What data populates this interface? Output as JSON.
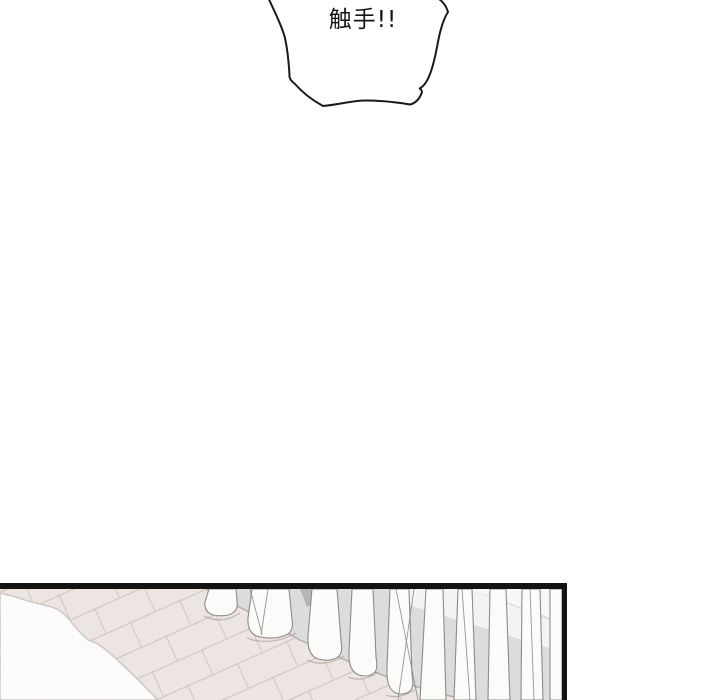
{
  "comic": {
    "speech_bubble": {
      "text": "触手!!",
      "fill": "#ffffff",
      "stroke": "#1a1a1a",
      "text_color": "#151515"
    },
    "panel": {
      "border_color": "#131313",
      "scene_colors": {
        "floor": "#ece5e1",
        "floor_seam": "#cdc2bb",
        "rug": "#fcfcfc",
        "rug_edge": "#cfc9c5",
        "wall": "#dcdcde",
        "wall_gap_shadow": "#b8b4b1",
        "wall_highlight": "#f7f7f8",
        "baseboard_line": "#b3aeaa",
        "curtain": "#fbfbfa",
        "curtain_outline": "#8f8b87",
        "hem_shadow": "#b9ada6"
      }
    }
  }
}
